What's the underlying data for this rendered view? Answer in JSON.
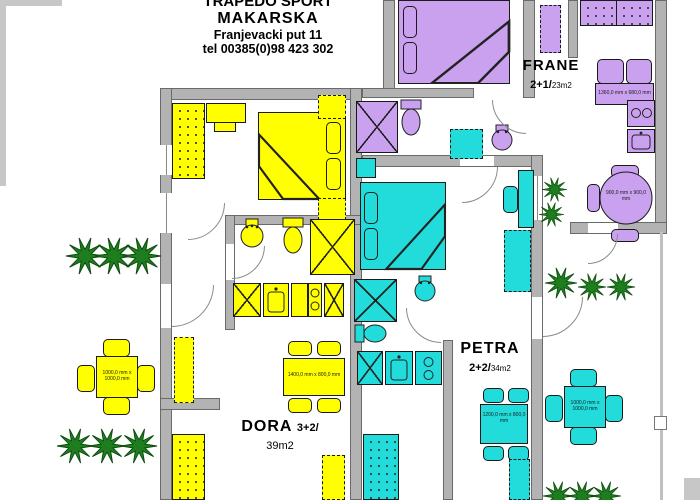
{
  "header": {
    "line1": "TRAPEDO SPORT",
    "line2": "MAKARSKA",
    "line3": "Franjevacki put 11",
    "line4": "tel 00385(0)98 423 302"
  },
  "apartments": [
    {
      "name": "FRANE",
      "capacity": "2+1/",
      "area": "23m2",
      "color": "#c9a1ef"
    },
    {
      "name": "PETRA",
      "capacity": "2+2/",
      "area": "34m2",
      "color": "#22dcdc"
    },
    {
      "name": "DORA",
      "capacity": "3+2/",
      "area": "39m2",
      "color": "#ffff00"
    }
  ],
  "dimensions": {
    "frane_sofa": "1360,0 mm x 680,0 mm",
    "frane_round_table": "900,0 mm x 900,0 mm",
    "dora_dining_table": "1400,0 mm x 800,0 mm",
    "petra_dining_table": "1200,0 mm x 800,0 mm",
    "dora_terrace_table": "1000,0 mm x 1000,0 mm",
    "petra_terrace_table": "1000,0 mm x 1000,0 mm"
  },
  "colors": {
    "wall": "#b3b3b3",
    "dora": "#ffff00",
    "petra": "#22dcdc",
    "frane": "#c9a1ef",
    "plant": "#1e7d1e"
  }
}
